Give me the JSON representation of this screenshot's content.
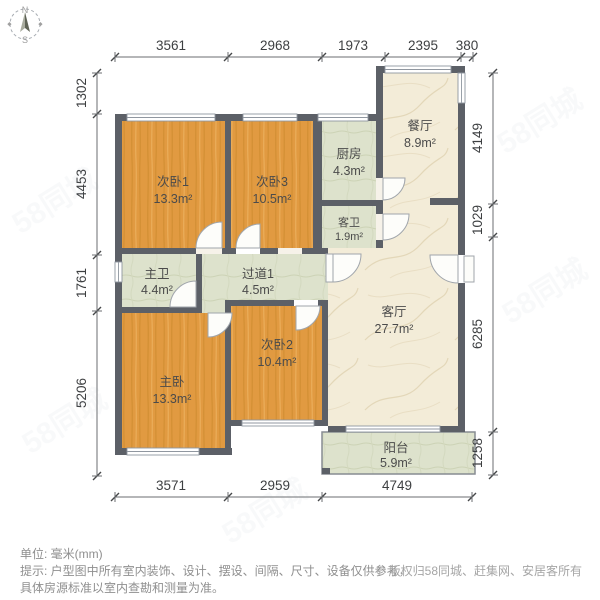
{
  "compass": {
    "north": "N",
    "south": "S"
  },
  "dims": {
    "top": [
      "3561",
      "2968",
      "1973",
      "2395",
      "380"
    ],
    "left": [
      "1302",
      "4453",
      "1761",
      "5206"
    ],
    "right": [
      "4149",
      "1029",
      "6285",
      "1258"
    ],
    "bottom": [
      "3571",
      "2959",
      "4749"
    ]
  },
  "rooms": [
    {
      "id": "bedroom1",
      "name": "次卧1",
      "area": "13.3m²"
    },
    {
      "id": "bedroom3",
      "name": "次卧3",
      "area": "10.5m²"
    },
    {
      "id": "kitchen",
      "name": "厨房",
      "area": "4.3m²"
    },
    {
      "id": "dining",
      "name": "餐厅",
      "area": "8.9m²"
    },
    {
      "id": "bath-guest",
      "name": "客卫",
      "area": "1.9m²"
    },
    {
      "id": "bath-master",
      "name": "主卫",
      "area": "4.4m²"
    },
    {
      "id": "hallway",
      "name": "过道1",
      "area": "4.5m²"
    },
    {
      "id": "living",
      "name": "客厅",
      "area": "27.7m²"
    },
    {
      "id": "bedroom-master",
      "name": "主卧",
      "area": "13.3m²"
    },
    {
      "id": "bedroom2",
      "name": "次卧2",
      "area": "10.4m²"
    },
    {
      "id": "balcony",
      "name": "阳台",
      "area": "5.9m²"
    }
  ],
  "footer": {
    "unit_line": "单位: 毫米(mm)",
    "hint_line1": "提示: 户型图中所有室内装饰、设计、摆设、间隔、尺寸、设备仅供参考，",
    "hint_line2": "具体房源标准以室内查勘和测量为准。",
    "copyright": "© 版权归58同城、赶集网、安居客所有"
  },
  "watermark": {
    "text": "58同城"
  },
  "colors": {
    "wall": "#5c6067",
    "wood": "#e19a41",
    "tile": "#dde2cc",
    "marble": "#f3ecd8"
  }
}
